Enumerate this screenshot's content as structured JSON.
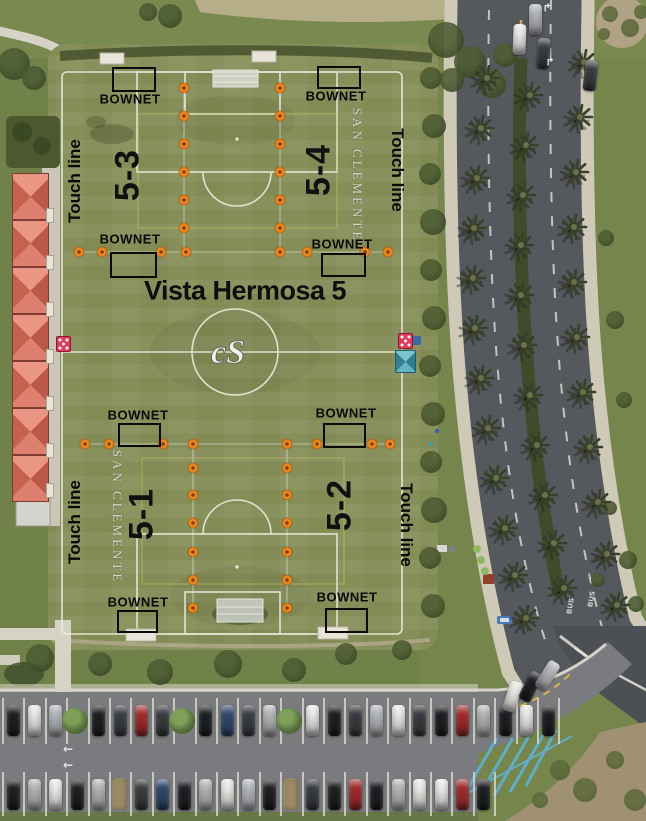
{
  "map": {
    "title": "Vista Hermosa 5",
    "venue_name": "SAN CLEMENTE",
    "goal_label": "BOWNET",
    "touch_line_label": "Touch line",
    "fields": [
      {
        "label": "5-3",
        "x": 128,
        "y": 175,
        "rot": -90
      },
      {
        "label": "5-4",
        "x": 319,
        "y": 170,
        "rot": -90
      },
      {
        "label": "5-1",
        "x": 142,
        "y": 514,
        "rot": -90
      },
      {
        "label": "5-2",
        "x": 340,
        "y": 505,
        "rot": -90
      }
    ],
    "bownets": [
      {
        "tx": 130,
        "ty": 99,
        "rx": 112,
        "ry": 67,
        "rw": 40,
        "rh": 21
      },
      {
        "tx": 336,
        "ty": 96,
        "rx": 317,
        "ry": 66,
        "rw": 40,
        "rh": 19
      },
      {
        "tx": 130,
        "ty": 239,
        "rx": 110,
        "ry": 252,
        "rw": 43,
        "rh": 22
      },
      {
        "tx": 342,
        "ty": 244,
        "rx": 321,
        "ry": 253,
        "rw": 41,
        "rh": 20
      },
      {
        "tx": 138,
        "ty": 415,
        "rx": 118,
        "ry": 423,
        "rw": 39,
        "rh": 20
      },
      {
        "tx": 346,
        "ty": 413,
        "rx": 323,
        "ry": 423,
        "rw": 39,
        "rh": 21
      },
      {
        "tx": 138,
        "ty": 602,
        "rx": 117,
        "ry": 610,
        "rw": 37,
        "rh": 19
      },
      {
        "tx": 347,
        "ty": 597,
        "rx": 325,
        "ry": 608,
        "rw": 39,
        "rh": 21
      }
    ],
    "touch_lines": [
      {
        "x": 75,
        "y": 181,
        "rot": -90
      },
      {
        "x": 397,
        "y": 170,
        "rot": 90
      },
      {
        "x": 75,
        "y": 522,
        "rot": -90
      },
      {
        "x": 406,
        "y": 525,
        "rot": 90
      }
    ],
    "san_clemente": [
      {
        "x": 357,
        "y": 175,
        "rot": 90
      },
      {
        "x": 117,
        "y": 517,
        "rot": 90
      }
    ],
    "markers": [
      [
        184,
        88
      ],
      [
        184,
        116
      ],
      [
        184,
        144
      ],
      [
        184,
        172
      ],
      [
        184,
        200
      ],
      [
        184,
        228
      ],
      [
        280,
        88
      ],
      [
        280,
        116
      ],
      [
        280,
        144
      ],
      [
        280,
        172
      ],
      [
        280,
        200
      ],
      [
        280,
        228
      ],
      [
        79,
        252
      ],
      [
        102,
        252
      ],
      [
        161,
        252
      ],
      [
        186,
        252
      ],
      [
        280,
        252
      ],
      [
        307,
        252
      ],
      [
        365,
        252
      ],
      [
        388,
        252
      ],
      [
        85,
        444
      ],
      [
        109,
        444
      ],
      [
        163,
        444
      ],
      [
        193,
        444
      ],
      [
        287,
        444
      ],
      [
        317,
        444
      ],
      [
        372,
        444
      ],
      [
        390,
        444
      ],
      [
        193,
        468
      ],
      [
        193,
        495
      ],
      [
        193,
        523
      ],
      [
        193,
        552
      ],
      [
        193,
        580
      ],
      [
        193,
        608
      ],
      [
        287,
        468
      ],
      [
        287,
        495
      ],
      [
        287,
        523
      ],
      [
        287,
        552
      ],
      [
        287,
        580
      ],
      [
        287,
        608
      ]
    ],
    "marker_color": "#f18d26"
  },
  "road": {
    "bus_label": "BUS",
    "turn_arrow": "↱",
    "aisle_arrow": "←",
    "bus_positions": [
      {
        "x": 571,
        "y": 606,
        "rot": -80
      },
      {
        "x": 592,
        "y": 599,
        "rot": -80
      }
    ],
    "turn_arrow_positions": [
      {
        "x": 547,
        "y": 8
      },
      {
        "x": 550,
        "y": 62
      }
    ],
    "aisle_arrow_positions": [
      {
        "x": 68,
        "y": 749
      },
      {
        "x": 68,
        "y": 765
      }
    ]
  },
  "aerial": {
    "palms": [
      [
        487,
        78
      ],
      [
        481,
        128
      ],
      [
        477,
        178
      ],
      [
        474,
        228
      ],
      [
        473,
        278
      ],
      [
        475,
        328
      ],
      [
        481,
        378
      ],
      [
        488,
        428
      ],
      [
        496,
        478
      ],
      [
        505,
        528
      ],
      [
        515,
        575
      ],
      [
        526,
        618
      ],
      [
        530,
        95
      ],
      [
        526,
        145
      ],
      [
        523,
        195
      ],
      [
        521,
        245
      ],
      [
        521,
        295
      ],
      [
        524,
        345
      ],
      [
        530,
        395
      ],
      [
        537,
        445
      ],
      [
        545,
        495
      ],
      [
        554,
        543
      ],
      [
        564,
        588
      ],
      [
        584,
        62
      ],
      [
        580,
        117
      ],
      [
        576,
        172
      ],
      [
        574,
        227
      ],
      [
        574,
        282
      ],
      [
        577,
        337
      ],
      [
        583,
        392
      ],
      [
        590,
        447
      ],
      [
        598,
        502
      ],
      [
        607,
        554
      ],
      [
        617,
        605
      ]
    ],
    "parking": {
      "stall_w": 21.4,
      "top_row_y": 698,
      "top_row_h": 46,
      "top_pattern": "kwstkdrdtkbdstwkdswdkrskwk",
      "bot_row_y": 772,
      "bot_row_h": 44,
      "bot_pattern": "kswksndbkswskndkrkswwrk"
    },
    "extra_cars": [
      {
        "x": 506,
        "y": 681,
        "r": 18,
        "c": "w"
      },
      {
        "x": 524,
        "y": 671,
        "r": 26,
        "c": "k"
      },
      {
        "x": 541,
        "y": 660,
        "r": 32,
        "c": "s"
      },
      {
        "x": 513,
        "y": 24,
        "r": 2,
        "c": "w"
      },
      {
        "x": 529,
        "y": 4,
        "r": 0,
        "c": "s"
      },
      {
        "x": 537,
        "y": 38,
        "r": 4,
        "c": "d"
      },
      {
        "x": 584,
        "y": 60,
        "r": 6,
        "c": "d"
      }
    ],
    "car_colors": {
      "k": "#1d1f22",
      "d": "#3a3d41",
      "w": "#e9e9e6",
      "s": "#b4b7ba",
      "r": "#a32c2c",
      "b": "#2f4a6e",
      "g": "#73767a"
    },
    "trees_dark": [
      [
        431,
        78,
        11
      ],
      [
        434,
        126,
        12
      ],
      [
        430,
        174,
        11
      ],
      [
        433,
        222,
        13
      ],
      [
        431,
        270,
        11
      ],
      [
        434,
        318,
        12
      ],
      [
        430,
        366,
        11
      ],
      [
        433,
        414,
        12
      ],
      [
        431,
        462,
        11
      ],
      [
        434,
        510,
        13
      ],
      [
        430,
        558,
        11
      ],
      [
        433,
        606,
        12
      ],
      [
        40,
        658,
        14
      ],
      [
        100,
        664,
        12
      ],
      [
        160,
        672,
        13
      ],
      [
        228,
        664,
        14
      ],
      [
        294,
        670,
        12
      ],
      [
        346,
        654,
        11
      ],
      [
        402,
        650,
        10
      ],
      [
        446,
        40,
        18
      ],
      [
        470,
        62,
        16
      ],
      [
        492,
        84,
        14
      ],
      [
        452,
        80,
        12
      ],
      [
        505,
        55,
        12
      ],
      [
        14,
        64,
        16
      ],
      [
        34,
        78,
        12
      ],
      [
        170,
        16,
        12
      ],
      [
        148,
        12,
        9
      ],
      [
        606,
        238,
        8
      ],
      [
        615,
        320,
        9
      ],
      [
        624,
        400,
        8
      ],
      [
        610,
        508,
        7
      ],
      [
        628,
        560,
        9
      ],
      [
        636,
        604,
        8
      ],
      [
        598,
        580,
        7
      ]
    ],
    "scrub_dark": [
      [
        610,
        14,
        8
      ],
      [
        630,
        28,
        9
      ],
      [
        641,
        12,
        7
      ],
      [
        604,
        34,
        6
      ],
      [
        560,
        770,
        10
      ],
      [
        585,
        790,
        12
      ],
      [
        615,
        760,
        9
      ],
      [
        635,
        800,
        11
      ],
      [
        540,
        800,
        8
      ]
    ],
    "green_dots": [
      [
        477,
        549,
        4
      ],
      [
        481,
        560,
        4
      ],
      [
        485,
        571,
        4
      ]
    ]
  }
}
